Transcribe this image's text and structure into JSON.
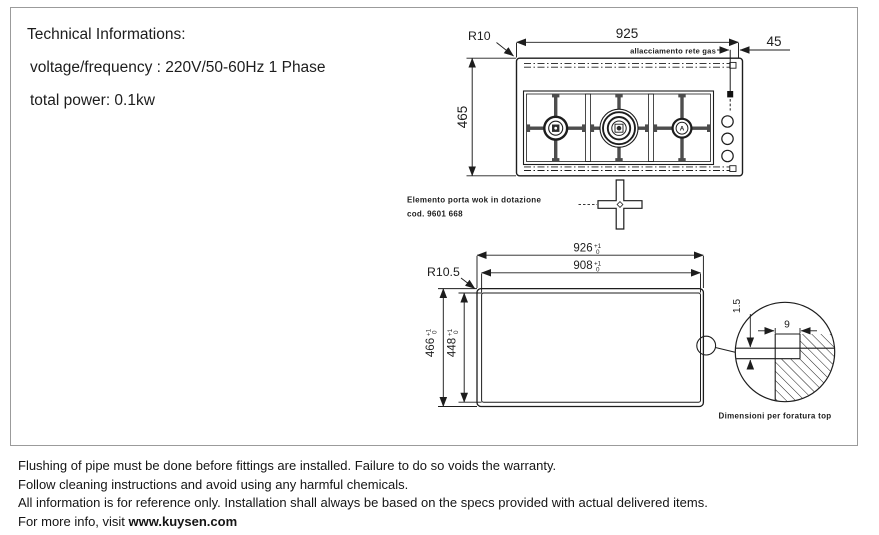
{
  "page": {
    "ink_color": "#1d1d1d",
    "frame_border_color": "#9b9b9b",
    "background": "#ffffff"
  },
  "tech_info": {
    "title": "Technical Informations:",
    "voltage": "voltage/frequency : 220V/50-60Hz 1 Phase",
    "power": "total power: 0.1kw"
  },
  "top_drawing": {
    "width_dim": "925",
    "height_dim": "465",
    "gas_offset_dim": "45",
    "corner_radius": "R10",
    "gas_label": "allacciamento rete gas",
    "right_burner_letter": "A"
  },
  "wok_note": {
    "line1": "Elemento porta wok in dotazione",
    "line2": "cod. 9601 668"
  },
  "cutout_drawing": {
    "corner_radius": "R10.5",
    "outer_width": {
      "value": "926",
      "tol_up": "+1",
      "tol_dn": "0"
    },
    "inner_width": {
      "value": "908",
      "tol_up": "+1",
      "tol_dn": "0"
    },
    "outer_height": {
      "value": "466",
      "tol_up": "+1",
      "tol_dn": "0"
    },
    "inner_height": {
      "value": "448",
      "tol_up": "+1",
      "tol_dn": "0"
    },
    "detail": {
      "tab_dim": "9",
      "lip_dim": "1.5",
      "caption": "Dimensioni per foratura top"
    }
  },
  "footer": {
    "lines": [
      "Flushing of pipe must be done before fittings are installed. Failure to do so voids the warranty.",
      "Follow cleaning instructions and avoid using any harmful chemicals.",
      "All information is for reference only. Installation shall always be based on the specs provided with actual delivered items."
    ],
    "more_info_prefix": "For more info, visit ",
    "website": "www.kuysen.com"
  }
}
